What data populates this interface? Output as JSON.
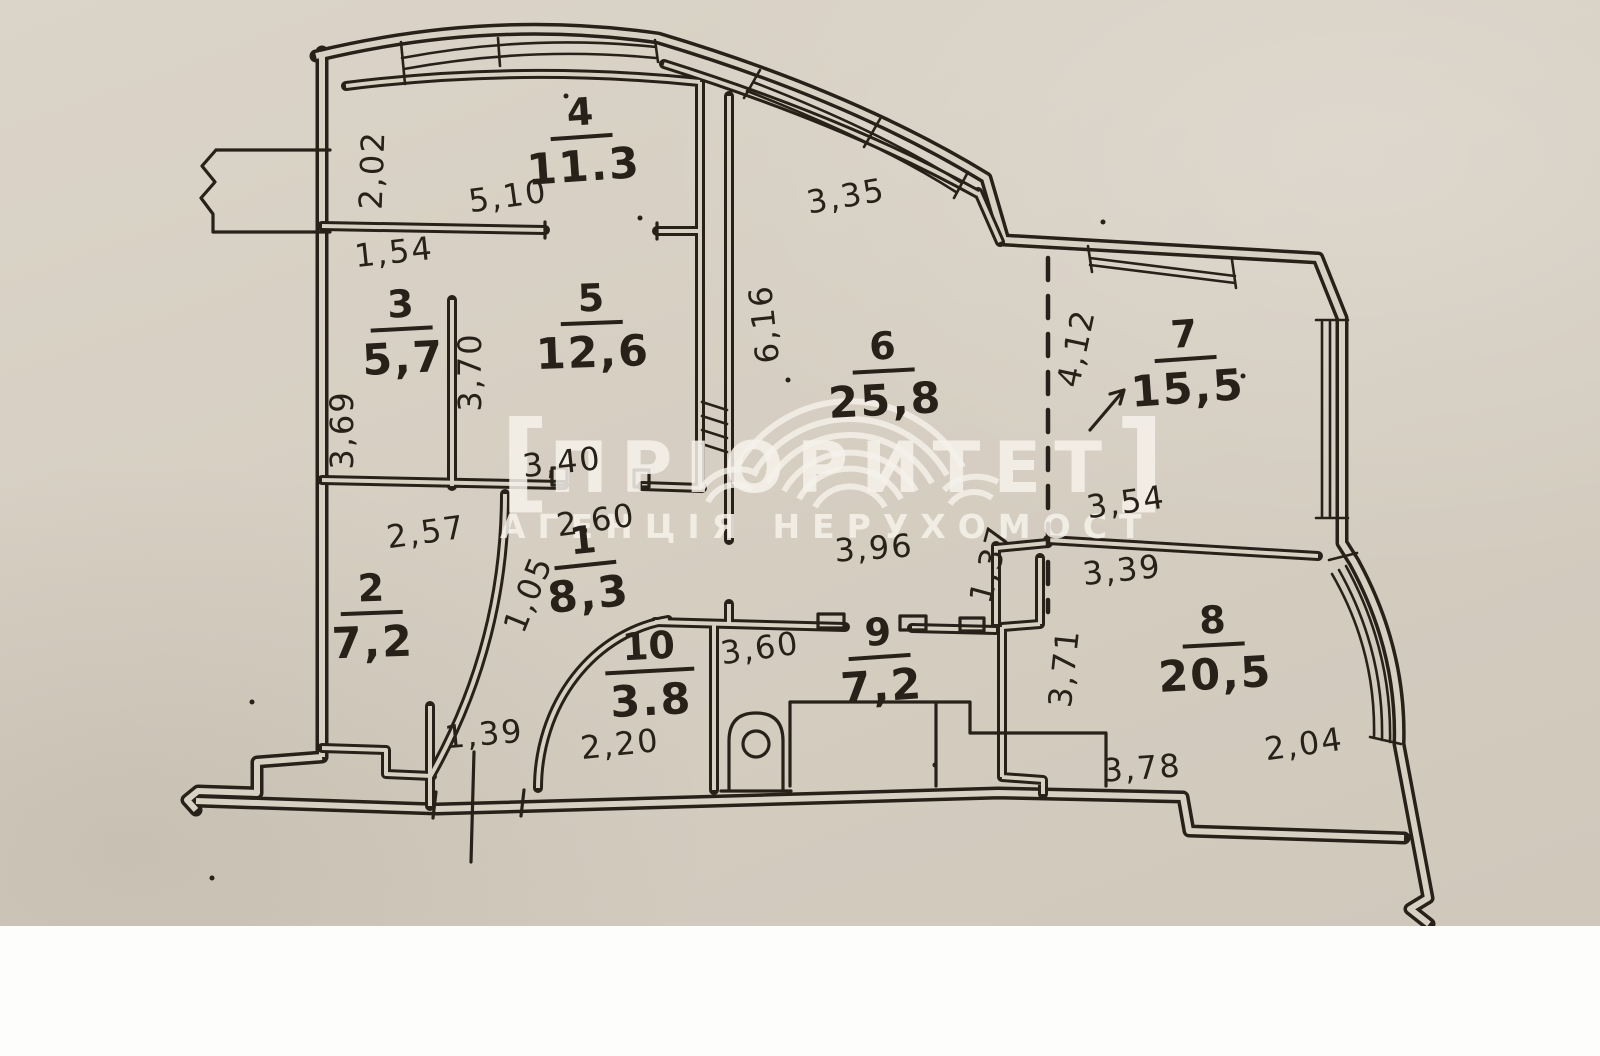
{
  "palette": {
    "paper": "#d8d0c3",
    "paper_light": "#e2dbd0",
    "ink": "#272119",
    "margin_white": "#fdfdfb",
    "wm": "#f6f3ec"
  },
  "watermark": {
    "bracket_left": "[",
    "brand": "ПРІОРИТЕТ",
    "bracket_right": "]",
    "subtitle": "АГЕНЦІЯ НЕРУХОМОСТ"
  },
  "rooms": [
    {
      "number": "1",
      "area": "8,3"
    },
    {
      "number": "2",
      "area": "7,2"
    },
    {
      "number": "3",
      "area": "5,7"
    },
    {
      "number": "4",
      "area": "11.3"
    },
    {
      "number": "5",
      "area": "12,6"
    },
    {
      "number": "6",
      "area": "25,8"
    },
    {
      "number": "7",
      "area": "15,5"
    },
    {
      "number": "8",
      "area": "20,5"
    },
    {
      "number": "9",
      "area": "7,2"
    },
    {
      "number": "10",
      "area": "3.8"
    }
  ],
  "dimensions": {
    "d202": "2,02",
    "d510": "5,10",
    "d154": "1,54",
    "d369": "3,69",
    "d370": "3,70",
    "d335": "3,35",
    "d616": "6,16",
    "d412": "4,12",
    "d354": "3,54",
    "d340": "3,40",
    "d260": "2,60",
    "d257": "2,57",
    "d105": "1,05",
    "d396": "3,96",
    "d137": "1,37",
    "d339": "3,39",
    "d371": "3,71",
    "d378": "3,78",
    "d204": "2,04",
    "d360": "3,60",
    "d220": "2,20",
    "d139": "1,39"
  }
}
